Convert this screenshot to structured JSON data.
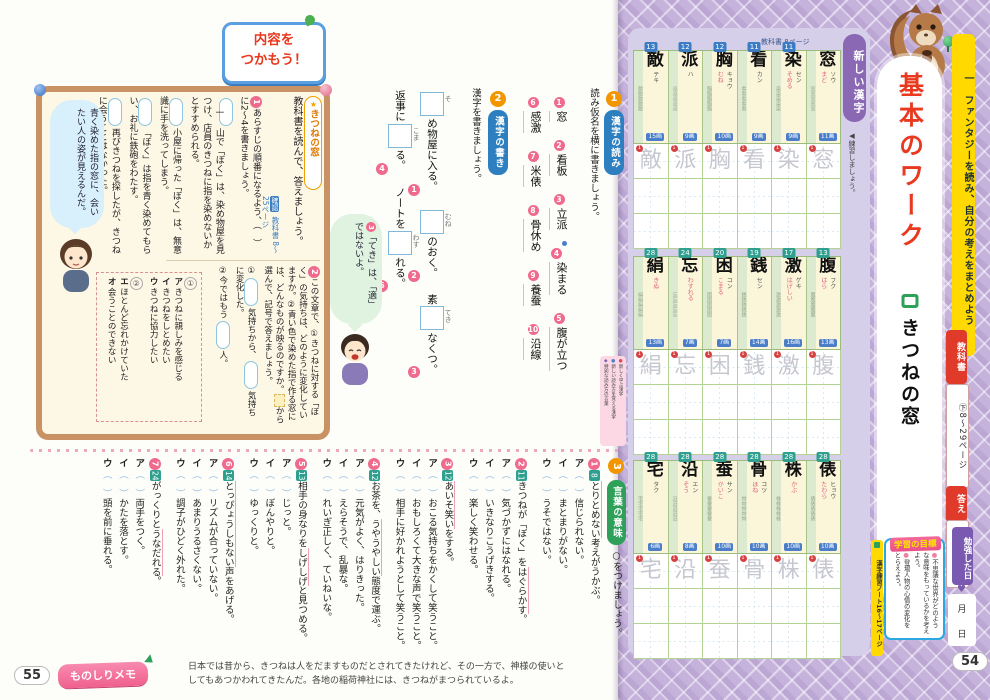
{
  "sidebar": {
    "unit_label": "一　ファンタジーを読み、自分の考えをまとめよう",
    "lesson_type": "基本のワーク",
    "lesson_title": "きつねの窓",
    "textbook_badge": "教科書",
    "textbook_pages": "㊦8〜29ページ",
    "answers_badge": "答え",
    "answers_pages": "12ページ",
    "study_date_label": "勉強した日",
    "month_label": "月",
    "day_label": "日",
    "goals_title": "学習の目標",
    "goals": [
      "不思議な世界がどのような意味をもっているかを考えよう。",
      "登場人物の心情の変化をとらえよう。"
    ],
    "kanji_note": "漢字練習ノート16〜17ページ",
    "page_number": "54"
  },
  "kanji_panel": {
    "header_label": "新しい漢字",
    "textbook_page_label": "教科書 8ページ",
    "practice_label": "◀練習しましょう。",
    "rows": [
      [
        {
          "char": "敵",
          "page": "13",
          "on": "テキ",
          "kun": "",
          "strokes": "15画"
        },
        {
          "char": "派",
          "page": "12",
          "on": "ハ",
          "kun": "",
          "strokes": "9画"
        },
        {
          "char": "胸",
          "page": "12",
          "on": "キョウ",
          "kun": "むね",
          "strokes": "10画"
        },
        {
          "char": "看",
          "page": "11",
          "on": "カン",
          "kun": "",
          "strokes": "9画"
        },
        {
          "char": "染",
          "page": "11",
          "on": "セン",
          "kun": "そめる",
          "strokes": "9画"
        },
        {
          "char": "窓",
          "page": "",
          "on": "ソウ",
          "kun": "まど",
          "strokes": "11画"
        }
      ],
      [
        {
          "char": "絹",
          "page": "28",
          "on": "",
          "kun": "きぬ",
          "strokes": "13画"
        },
        {
          "char": "忘",
          "page": "24",
          "on": "",
          "kun": "わすれる",
          "strokes": "7画"
        },
        {
          "char": "困",
          "page": "20",
          "on": "コン",
          "kun": "こまる",
          "strokes": "7画"
        },
        {
          "char": "銭",
          "page": "19",
          "on": "セン",
          "kun": "",
          "strokes": "14画"
        },
        {
          "char": "激",
          "page": "17",
          "on": "ゲキ",
          "kun": "はげしい",
          "strokes": "16画"
        },
        {
          "char": "腹",
          "page": "13",
          "on": "フク",
          "kun": "はら",
          "strokes": "13画"
        }
      ],
      [
        {
          "char": "宅",
          "page": "28",
          "on": "タク",
          "kun": "",
          "strokes": "6画"
        },
        {
          "char": "沿",
          "page": "28",
          "on": "エン",
          "kun": "そう",
          "strokes": "8画"
        },
        {
          "char": "蚕",
          "page": "28",
          "on": "サン",
          "kun": "かいこ",
          "strokes": "10画"
        },
        {
          "char": "骨",
          "page": "28",
          "on": "コツ",
          "kun": "ほね",
          "strokes": "10画"
        },
        {
          "char": "株",
          "page": "28",
          "on": "",
          "kun": "かぶ",
          "strokes": "10画"
        },
        {
          "char": "俵",
          "page": "28",
          "on": "ヒョウ",
          "kun": "たわら",
          "strokes": "10画"
        }
      ]
    ]
  },
  "main": {
    "catch_line1": "内容を",
    "catch_line2": "つかもう！",
    "box1": {
      "tag": "きつねの窓",
      "intro": "教科書を読んで、答えましょう。",
      "check_badge": "確認",
      "check_pages": "教科書 8〜25ページ",
      "q1_num": "1",
      "q1_text": "あらすじの順番になるよう、（　）に2〜4を書きましょう。",
      "q1_items": [
        {
          "mark": "一",
          "text": "山で「ぼく」は、染め物屋を見つけ、店員のきつねに指を染めないかとすすめられる。"
        },
        {
          "mark": "",
          "text": "小屋に帰った「ぼく」は、無意識に手を洗ってしまう。"
        },
        {
          "mark": "",
          "text": "「ぼく」は指を青く染めてもらい、お礼に鉄砲をわたす。"
        },
        {
          "mark": "",
          "text": "再びきつねを探したが、きつねに会うことはなかった。"
        }
      ],
      "bubble": "青く染めた指の窓に、会いたい人の姿が見えるんだ。",
      "q2_num": "2",
      "q2_text1": "この文章で、①きつねに対する「ぼく」の気持ちは、どのように変化していますか。②青い色で染めた指で作る窓には、どんなものが映るのですか。",
      "q2_text2": "から選んで、記号で答えましょう。",
      "q2_answers": [
        {
          "segments": [
            {
              "t": "①"
            },
            {
              "b": true
            },
            {
              "t": "気持ちから、"
            },
            {
              "b": true
            },
            {
              "t": "気持ちに変化した。"
            }
          ]
        },
        {
          "segments": [
            {
              "t": "②今ではもう"
            },
            {
              "b": true
            },
            {
              "t": "人。"
            }
          ]
        }
      ],
      "option_groups": [
        {
          "label": "①",
          "options": [
            {
              "key": "ア",
              "text": "きつねに親しみを感じる"
            },
            {
              "key": "イ",
              "text": "きつねをしとめたい"
            },
            {
              "key": "ウ",
              "text": "きつねに協力したい"
            }
          ]
        },
        {
          "label": "②",
          "options": [
            {
              "key": "エ",
              "text": "ほとんど忘れかけていた"
            },
            {
              "key": "オ",
              "text": "会うことのできない"
            }
          ]
        }
      ]
    },
    "reading": {
      "num": "1",
      "badge": "漢字の読み",
      "instruction": "読み仮名を横に書きましょう。",
      "items": [
        {
          "n": "1",
          "word": "窓",
          "mark": false
        },
        {
          "n": "2",
          "word": "看板",
          "mark": false
        },
        {
          "n": "3",
          "word": "立派",
          "mark": false
        },
        {
          "n": "4",
          "word": "染まる",
          "mark": true
        },
        {
          "n": "5",
          "word": "腹が立つ",
          "mark": false
        },
        {
          "n": "6",
          "word": "感激",
          "mark": false
        },
        {
          "n": "7",
          "word": "米俵",
          "mark": false
        },
        {
          "n": "8",
          "word": "骨休め",
          "mark": false
        },
        {
          "n": "9",
          "word": "養蚕",
          "mark": false
        },
        {
          "n": "10",
          "word": "沿線",
          "mark": false
        }
      ]
    },
    "writing": {
      "num": "2",
      "badge": "漢字の書き",
      "instruction": "漢字を書きましょう。",
      "items": [
        {
          "n": "1",
          "before": "",
          "reading": "そ",
          "after": "め物屋に入る。"
        },
        {
          "n": "2",
          "before": "",
          "reading": "むね",
          "after": "のおく。"
        },
        {
          "n": "3",
          "before": "素",
          "reading": "てき",
          "after": "なくつ。"
        },
        {
          "n": "4",
          "before": "返事に",
          "reading": "こま",
          "after": "る。"
        },
        {
          "n": "5",
          "before": "ノートを",
          "reading": "わす",
          "after": "れる。"
        }
      ]
    },
    "bubble2": {
      "num": "3",
      "text": "「てき」は、「適」ではないよ。"
    },
    "legend": [
      {
        "bullet": "●",
        "color": "#e8415a",
        "text": "新しく学ぶ漢字"
      },
      {
        "bullet": "●",
        "color": "#4a7ec8",
        "text": "新しい読み方を覚える漢字"
      },
      {
        "bullet": "◆",
        "color": "#7a5ab0",
        "text": "特別な読み方の言葉"
      }
    ],
    "meaning": {
      "num": "3",
      "badge": "言葉の意味",
      "instruction": "○をつけましょう。",
      "keys": [
        "ア",
        "イ",
        "ウ"
      ],
      "questions": [
        {
          "n": "1",
          "page": "8",
          "text": "とりとめない考えがうかぶ。",
          "key": "とりとめない",
          "options": [
            "信じられない。",
            "まとまりがない。",
            "うそではない。"
          ]
        },
        {
          "n": "2",
          "page": "11",
          "text": "きつねが「ぼく」をはぐらかす。",
          "key": "はぐらかす",
          "options": [
            "気づかずにはなれる。",
            "いきなりこうげきする。",
            "楽しく笑わせる。"
          ]
        },
        {
          "n": "3",
          "page": "12",
          "text": "あいそ笑いをする。",
          "key": "あいそ笑い",
          "options": [
            "おこる気持ちをかくして笑うこと。",
            "おもしろくて大きな声で笑うこと。",
            "相手に好かれようとして笑うこと。"
          ]
        },
        {
          "n": "4",
          "page": "12",
          "text": "お茶を、うやうやしい態度で運ぶ。",
          "key": "うやうやしい",
          "options": [
            "元気がよく、はりきった。",
            "えらそうで、乱暴な。",
            "れいぎ正しく、ていねいな。"
          ]
        },
        {
          "n": "5",
          "page": "13",
          "text": "相手の身なりをしげしげと見つめる。",
          "key": "しげしげ",
          "options": [
            "じっと。",
            "ぼんやりと。",
            "ゆっくりと。"
          ]
        },
        {
          "n": "6",
          "page": "14",
          "text": "とっぴょうしもない声をあげる。",
          "key": "とっぴょうしもない",
          "options": [
            "リズムが合っていない。",
            "あまりうるさくない。",
            "調子がひどく外れた。"
          ]
        },
        {
          "n": "7",
          "page": "24",
          "text": "がっくりとうなだれる。",
          "key": "うなだれる",
          "options": [
            "両手をつく。",
            "かたを落とす。",
            "頭を前に垂れる。"
          ]
        }
      ]
    }
  },
  "footer": {
    "page_number": "55",
    "memo_label": "ものしりメモ",
    "memo_line1": "日本では昔から、きつねは人をだますものだとされてきたけれど、その一方で、神様の使いと",
    "memo_line2": "してもあつかわれてきたんだ。各地の稲荷神社には、きつねがまつられているよ。"
  }
}
